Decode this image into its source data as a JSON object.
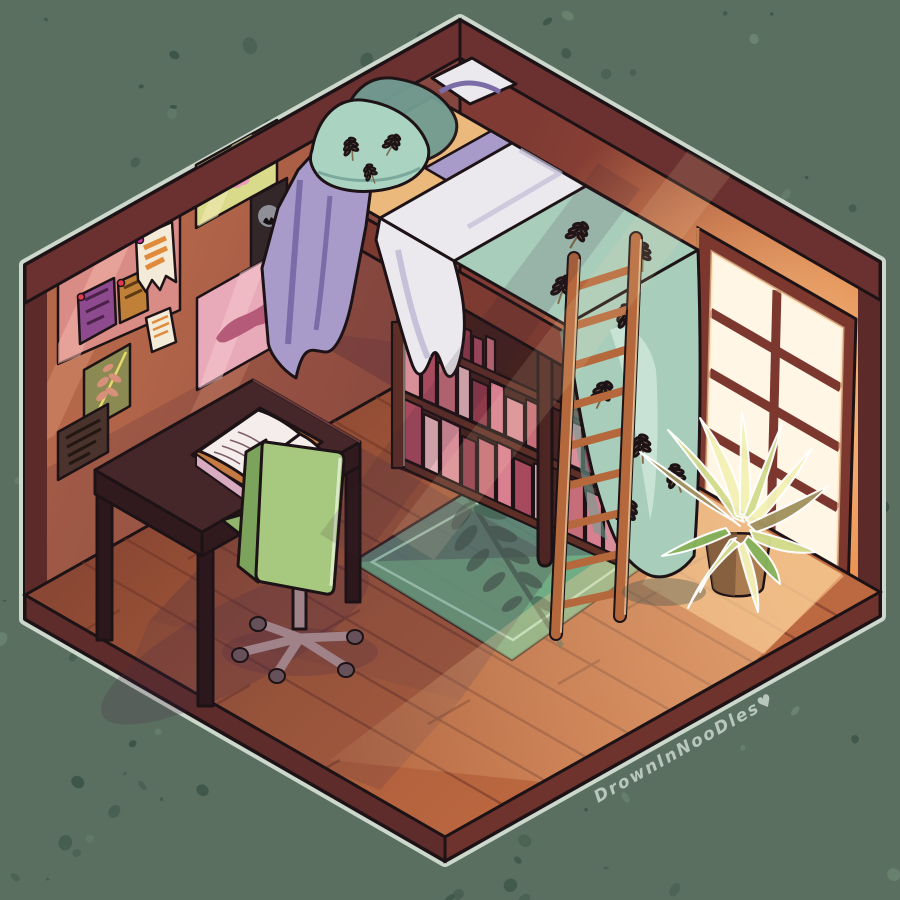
{
  "artwork": {
    "signature": "DrownInNooDles♥",
    "scene": "isometric cel-shaded bedroom with loft bed, warm window light",
    "objects": [
      "loft-bed",
      "bookshelf",
      "wooden-ladder",
      "sunlit-window",
      "potted-plant",
      "writing-desk",
      "office-chair",
      "area-rug",
      "pin-board",
      "wall-posters",
      "wall-plaque",
      "open-book"
    ]
  },
  "colors": {
    "bg": "#5a6f60",
    "speckle_dark": "#3a5346",
    "speckle_light": "#6e8673",
    "outline_light": "#cdd8cd",
    "ink": "#1d1316",
    "wall_left": "#ad6046",
    "wall_left_lit": "#e9a183",
    "wall_left_shadow": "#5c2f3a",
    "wall_trim": "#6b3130",
    "wall_edge": "#5c2b29",
    "wall_right": "#8a4237",
    "wall_right_lit": "#d5763f",
    "window_frame": "#7c382e",
    "window_pane": "#fff6e6",
    "window_glow": "#ffc277",
    "floor": "#a2583a",
    "floor_lit": "#c06f41",
    "floor_line": "#6e3528",
    "floor_shadow": "#472a44",
    "light_beam": "#ffcf96",
    "slab_left": "#5e2d2b",
    "slab_right": "#6e332c",
    "rug": "#548c80",
    "rug_lit": "#79c68e",
    "rug_border": "#b9eed2",
    "rug_leaf": "#3f5c4d",
    "bed_frame": "#7c3a30",
    "bed_frame_dark": "#602b27",
    "bed_post": "#4d2523",
    "mattress": "#ecb97c",
    "sheet_white": "#ebe9ee",
    "sheet_shadow": "#c2bcd6",
    "blanket_teal": "#a9cdbb",
    "blanket_teal_dark": "#719c92",
    "blanket_purple": "#a89bca",
    "blanket_purple_dark": "#7b6ca8",
    "pillow_teal": "#abd3c1",
    "sprig": "#7e6c4c",
    "shelf_frame": "#5d2f27",
    "shelf_interior": "#3f201f",
    "book1": "#d98f9a",
    "book2": "#a84a5e",
    "book3": "#c56d78",
    "book4": "#e7b6ba",
    "book5": "#8e3a4b",
    "book6": "#d87f90",
    "ladder": "#b4683c",
    "ladder_dark": "#7e4426",
    "desk": "#452629",
    "desk_dark": "#301a1e",
    "desk_leg": "#2c181c",
    "book_pages": "#f5ecec",
    "book_cover": "#c57a41",
    "book_edge": "#d8abc0",
    "scribble": "#7d5f6b",
    "chair": "#a7c97f",
    "chair_dark": "#7ca35c",
    "chair_seat": "#8fb66c",
    "chair_base": "#a08289",
    "chair_base_dark": "#66505a",
    "plant_light": "#f4f1b6",
    "plant_mid": "#d3dc8d",
    "plant_green": "#86b35c",
    "plant_shadowleaf": "#a3925f",
    "pot": "#aa7c50",
    "pot_dark": "#7b583a",
    "pinboard": "#d98c86",
    "note_purple": "#8e4a8e",
    "note_orange": "#c08038",
    "note_white": "#f3ead8",
    "note_stripe": "#e08a3c",
    "pin_red": "#e03a4e",
    "poster_flower_bg": "#d9da8a",
    "poster_flower_pink": "#e89cb8",
    "poster_flower_core": "#c06a88",
    "poster_dark_bg": "#33272a",
    "poster_moon": "#8f8f98",
    "poster_pink_bg": "#e8a9b8",
    "poster_pink_cat": "#b55a78",
    "poster_leaf_bg": "#8a8a52",
    "poster_leaf_pink": "#d8907a",
    "poster_leaf_stem": "#e8d86a",
    "plaque": "#4a332c",
    "plaque_line": "#241713",
    "signature_color": "#c3d0c5"
  }
}
